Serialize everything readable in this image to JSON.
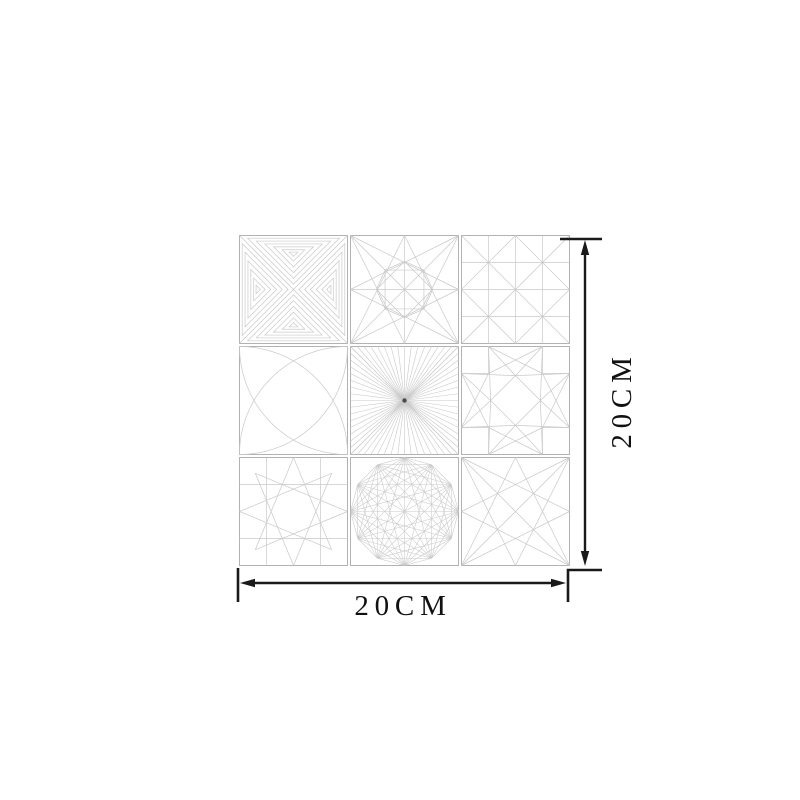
{
  "image": {
    "description": "Product dimension diagram of a 3x3 geometric line-pattern tile sheet",
    "background": "#ffffff"
  },
  "dimensions": {
    "width_label": "20CM",
    "height_label": "20CM",
    "arrow_color": "#1a1a1a"
  },
  "sheet": {
    "rows": 3,
    "cols": 3,
    "colors": {
      "pattern_line": "#c9c9c9",
      "tile_border": "#b2b2b2"
    },
    "tiles": [
      {
        "name": "nested-triangle-maze",
        "pattern": "nested_triangles"
      },
      {
        "name": "midpoint-fan-diamond",
        "pattern": "midpoint_star"
      },
      {
        "name": "grid-with-diagonals",
        "pattern": "grid_diagonals"
      },
      {
        "name": "corner-arc-rosette",
        "pattern": "corner_arcs"
      },
      {
        "name": "radial-sunburst",
        "pattern": "sunburst"
      },
      {
        "name": "notched-eight-point-star",
        "pattern": "notched_star"
      },
      {
        "name": "octagram-on-grid",
        "pattern": "octagram"
      },
      {
        "name": "dodecagon-web",
        "pattern": "dodecagon_web"
      },
      {
        "name": "corner-to-midpoint-star",
        "pattern": "corner_star"
      }
    ]
  }
}
